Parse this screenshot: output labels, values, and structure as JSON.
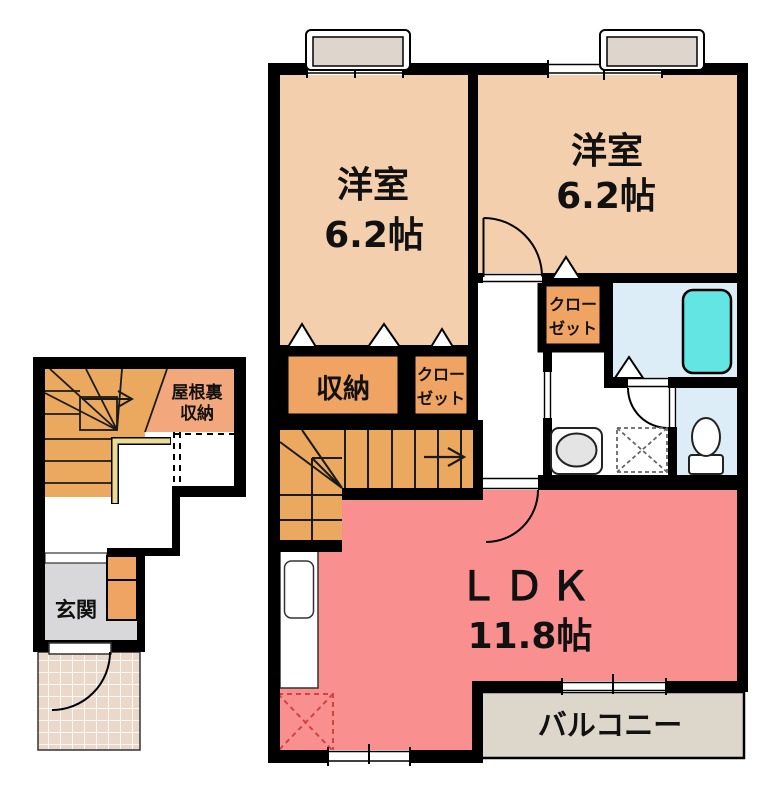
{
  "floor_plan": {
    "second_floor": {
      "bedroom_left": {
        "name": "洋室",
        "size": "6.2帖"
      },
      "bedroom_right": {
        "name": "洋室",
        "size": "6.2帖"
      },
      "ldk": {
        "name": "ＬＤＫ",
        "size": "11.8帖"
      },
      "storage_label": "収納",
      "closet_left": {
        "line1": "クロー",
        "line2": "ゼット"
      },
      "closet_right": {
        "line1": "クロー",
        "line2": "ゼット"
      },
      "balcony_label": "バルコニー"
    },
    "first_floor": {
      "attic_storage": {
        "line1": "屋根裏",
        "line2": "収納"
      },
      "entrance_label": "玄関"
    }
  },
  "colors": {
    "wall": "#000000",
    "bedroom": "#f4cfae",
    "storage_orange": "#f0a463",
    "stairs_orange": "#eba95f",
    "attic_salmon": "#f2a87c",
    "ldk_pink": "#f9908f",
    "balcony_beige": "#dcd6cb",
    "bath_floor_blue": "#dcedf7",
    "tub_cyan": "#63e6e3",
    "genkan_gray": "#d8d8da",
    "porch_tile": "#ead9cb",
    "railing_cream": "#eadc96",
    "window_box_fill": "#ded5cd",
    "fixture_gray": "#e4e4e4",
    "dashed_red": "#cc4444"
  }
}
